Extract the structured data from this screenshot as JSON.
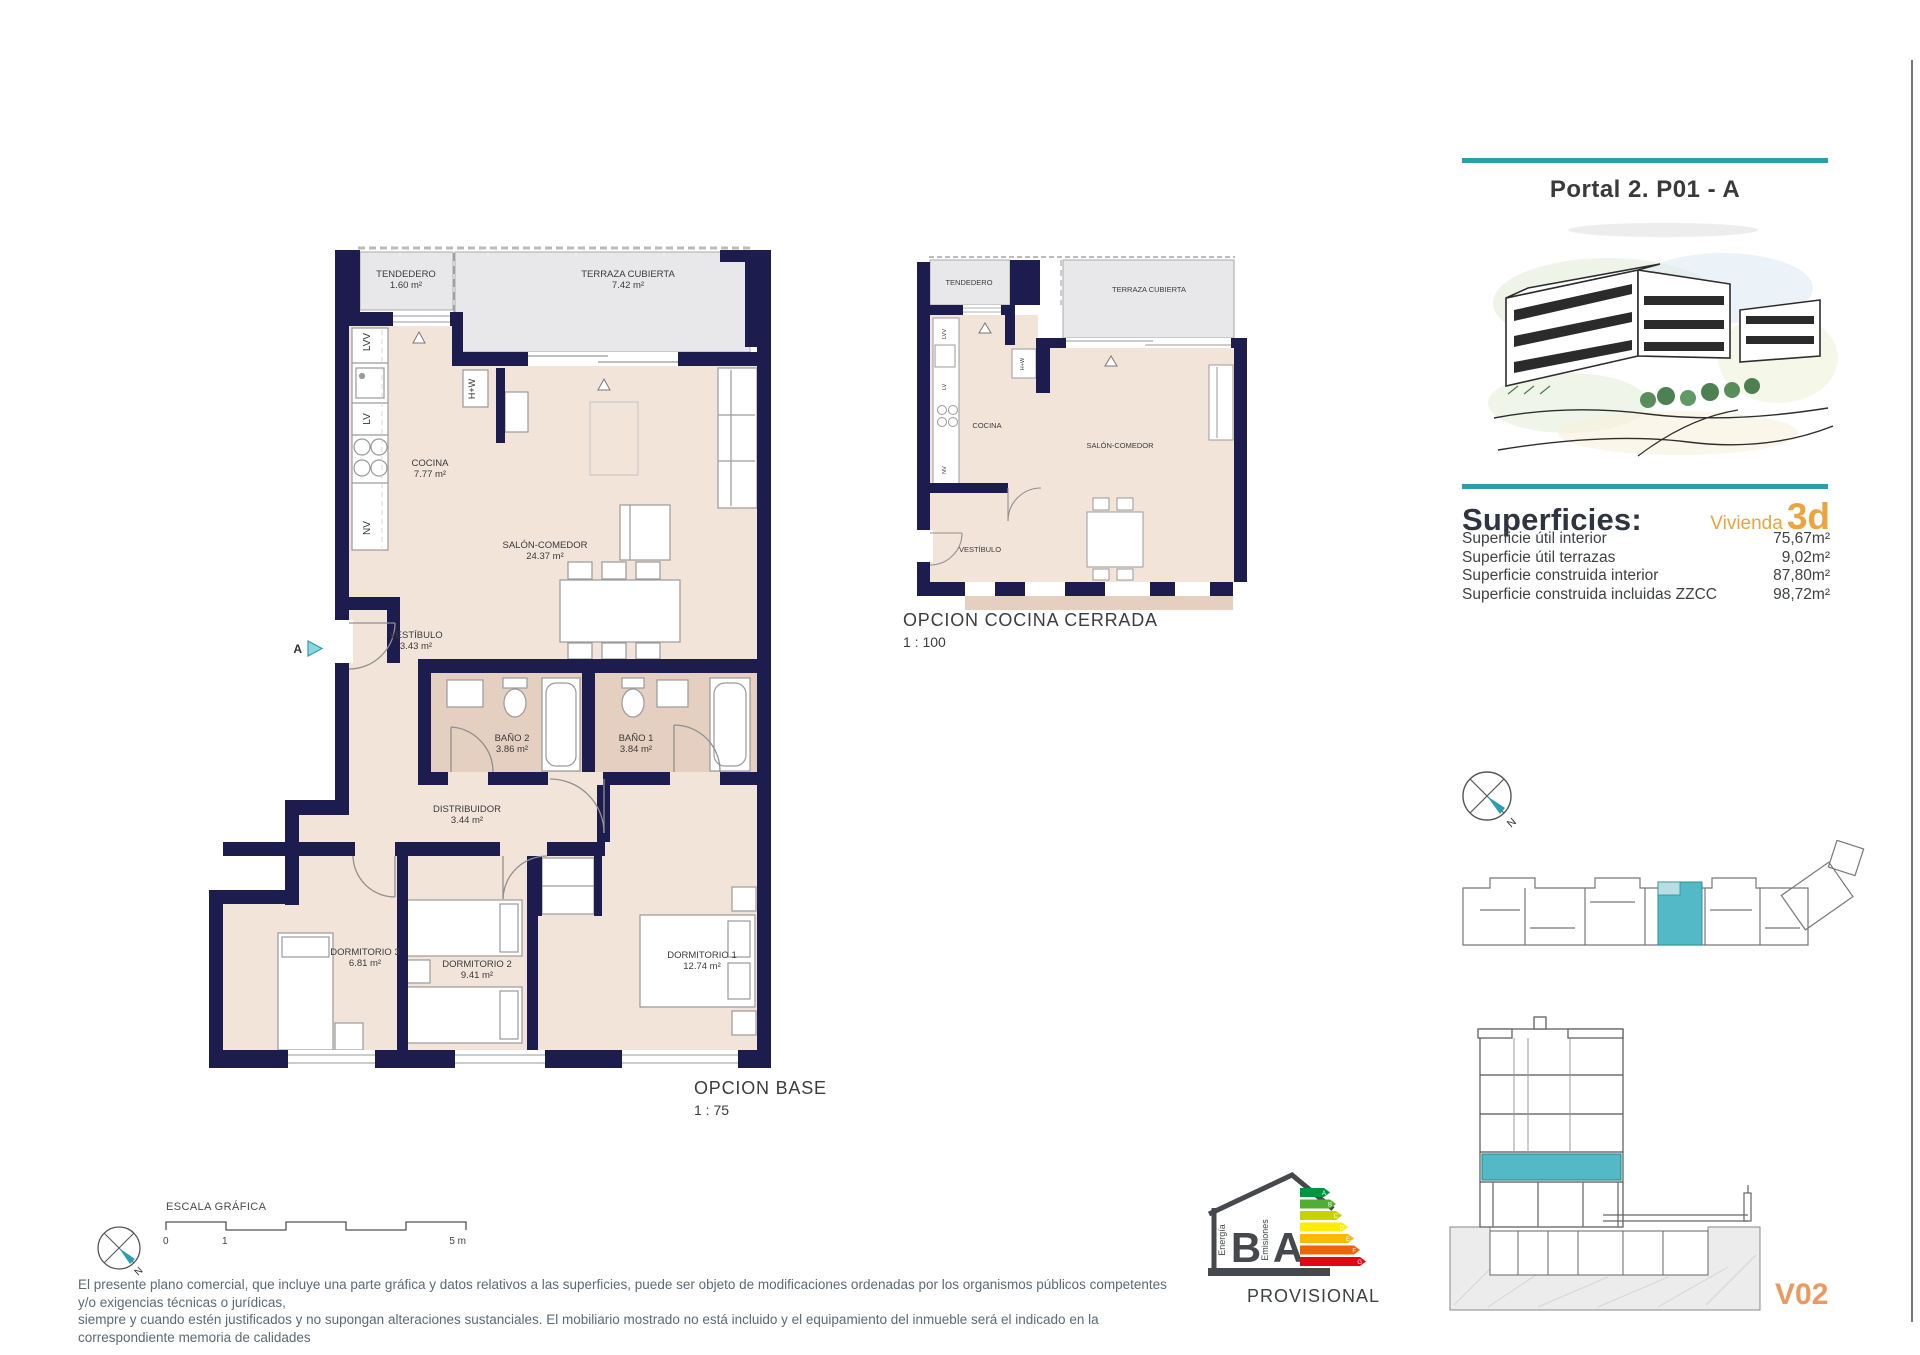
{
  "panel": {
    "title": "Portal 2. P01 - A"
  },
  "superficies": {
    "heading": "Superficies:",
    "vivienda_label": "Vivienda",
    "vivienda_code": "3d",
    "rows": [
      {
        "label": "Superficie útil interior",
        "value": "75,67m²"
      },
      {
        "label": "Superficie útil terrazas",
        "value": "9,02m²"
      },
      {
        "label": "Superficie construida interior",
        "value": "87,80m²"
      },
      {
        "label": "Superficie construida incluidas ZZCC",
        "value": "98,72m²"
      }
    ]
  },
  "main_plan": {
    "title": "OPCION BASE",
    "scale": "1 : 75",
    "entry_marker": "A",
    "rooms": {
      "tendedero": {
        "name": "TENDEDERO",
        "area": "1.60 m²"
      },
      "terraza": {
        "name": "TERRAZA CUBIERTA",
        "area": "7.42 m²"
      },
      "cocina": {
        "name": "COCINA",
        "area": "7.77 m²"
      },
      "salon": {
        "name": "SALÓN-COMEDOR",
        "area": "24.37 m²"
      },
      "vestibulo": {
        "name": "VESTÍBULO",
        "area": "3.43 m²"
      },
      "bano2": {
        "name": "BAÑO 2",
        "area": "3.86 m²"
      },
      "bano1": {
        "name": "BAÑO 1",
        "area": "3.84 m²"
      },
      "distribuidor": {
        "name": "DISTRIBUIDOR",
        "area": "3.44 m²"
      },
      "dorm3": {
        "name": "DORMITORIO 3",
        "area": "6.81 m²"
      },
      "dorm2": {
        "name": "DORMITORIO 2",
        "area": "9.41 m²"
      },
      "dorm1": {
        "name": "DORMITORIO 1",
        "area": "12.74 m²"
      }
    },
    "fixtures": {
      "lvv": "LVV",
      "lv": "LV",
      "nv": "NV",
      "hw": "H+W"
    }
  },
  "kitchen_plan": {
    "title": "OPCION COCINA CERRADA",
    "scale": "1 : 100",
    "rooms": {
      "tendedero": "TENDEDERO",
      "terraza": "TERRAZA CUBIERTA",
      "cocina": "COCINA",
      "salon": "SALÓN-COMEDOR",
      "vestibulo": "VESTÍBULO"
    },
    "fixtures": {
      "lvv": "LVV",
      "lv": "LV",
      "nv": "NV",
      "hw": "H+W"
    }
  },
  "scale_bar": {
    "title": "ESCALA GRÁFICA",
    "tick0": "0",
    "tick1": "1",
    "tick_end": "5 m"
  },
  "compass": {
    "north_label": "N"
  },
  "energy": {
    "energia_label": "Energía",
    "energia_rating": "B",
    "emisiones_label": "Emisiones",
    "emisiones_rating": "A",
    "status": "PROVISIONAL",
    "scale_letters": [
      "A",
      "B",
      "C",
      "D",
      "E",
      "F",
      "G"
    ],
    "colors": [
      "#009640",
      "#52ae32",
      "#c8d200",
      "#ffec00",
      "#fbba00",
      "#ec6608",
      "#e30613"
    ]
  },
  "footer": {
    "disclaimer_line1": "El presente plano comercial, que incluye una parte gráfica y datos relativos a las superficies, puede ser objeto de modificaciones ordenadas por los organismos públicos competentes y/o exigencias técnicas o jurídicas,",
    "disclaimer_line2": "siempre y cuando estén justificados y no supongan alteraciones sustanciales. El mobiliario mostrado no está incluido y el equipamiento del inmueble será el indicado en la correspondiente memoria de calidades",
    "version": "V02"
  },
  "colors": {
    "accent_teal": "#2b9fae",
    "wall_navy": "#1c1c4f",
    "floor_beige": "#f2e4d9",
    "bath_tan": "#e4cfc0",
    "terrace_gray": "#e8e8ea",
    "highlight_teal": "#54b9c6",
    "vivienda_orange": "#eba43e",
    "version_orange": "#ea9a60"
  }
}
